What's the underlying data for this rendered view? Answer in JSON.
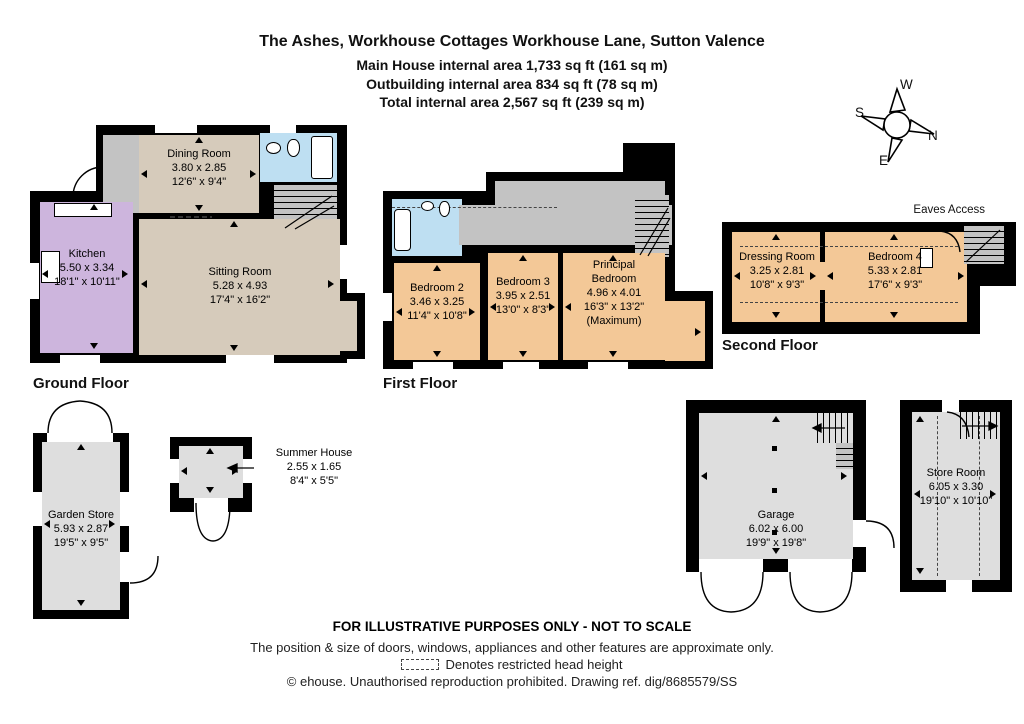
{
  "title": {
    "address": "The Ashes, Workhouse Cottages Workhouse Lane, Sutton Valence",
    "main_house": "Main House internal area 1,733 sq ft (161 sq m)",
    "outbuilding": "Outbuilding  internal area 834 sq ft (78 sq m)",
    "total": "Total internal area 2,567 sq ft (239 sq m)"
  },
  "compass": {
    "north": "N",
    "east": "E",
    "south": "S",
    "west": "W"
  },
  "floors": {
    "ground": {
      "caption": "Ground Floor",
      "rooms": {
        "kitchen": {
          "name": "Kitchen",
          "metric": "5.50 x 3.34",
          "imperial": "18'1\" x 10'11\""
        },
        "dining": {
          "name": "Dining Room",
          "metric": "3.80 x 2.85",
          "imperial": "12'6\" x 9'4\""
        },
        "sitting": {
          "name": "Sitting Room",
          "metric": "5.28 x 4.93",
          "imperial": "17'4\" x 16'2\""
        }
      }
    },
    "first": {
      "caption": "First Floor",
      "rooms": {
        "bedroom2": {
          "name": "Bedroom 2",
          "metric": "3.46 x 3.25",
          "imperial": "11'4\" x 10'8\""
        },
        "bedroom3": {
          "name": "Bedroom 3",
          "metric": "3.95 x 2.51",
          "imperial": "13'0\" x 8'3\""
        },
        "principal": {
          "name": "Principal Bedroom",
          "metric": "4.96 x 4.01",
          "imperial": "16'3\" x 13'2\"",
          "note": "(Maximum)"
        }
      }
    },
    "second": {
      "caption": "Second Floor",
      "eaves_access": "Eaves Access",
      "rooms": {
        "dressing": {
          "name": "Dressing Room",
          "metric": "3.25 x 2.81",
          "imperial": "10'8\" x 9'3\""
        },
        "bedroom4": {
          "name": "Bedroom 4",
          "metric": "5.33 x 2.81",
          "imperial": "17'6\" x 9'3\""
        }
      }
    }
  },
  "outbuildings": {
    "garden_store": {
      "name": "Garden Store",
      "metric": "5.93 x 2.87",
      "imperial": "19'5\" x 9'5\""
    },
    "summer_house": {
      "name": "Summer House",
      "metric": "2.55 x 1.65",
      "imperial": "8'4\" x 5'5\""
    },
    "garage": {
      "name": "Garage",
      "metric": "6.02 x 6.00",
      "imperial": "19'9\" x 19'8\""
    },
    "store_room": {
      "name": "Store Room",
      "metric": "6.05 x 3.30",
      "imperial": "19'10\" x 10'10\""
    }
  },
  "footer": {
    "line1": "FOR ILLUSTRATIVE PURPOSES ONLY - NOT TO SCALE",
    "line2": "The position & size of doors, windows, appliances and other features are approximate only.",
    "line3": "Denotes restricted head height",
    "line4": "© ehouse. Unauthorised reproduction prohibited. Drawing ref. dig/8685579/SS"
  },
  "colors": {
    "walls": "#000000",
    "living_rooms": "#d6cbbb",
    "kitchen": "#cdb5dd",
    "bathrooms": "#bedff2",
    "bedrooms": "#f3c897",
    "outbuildings": "#dedede",
    "circulation": "#c3c3c3"
  }
}
